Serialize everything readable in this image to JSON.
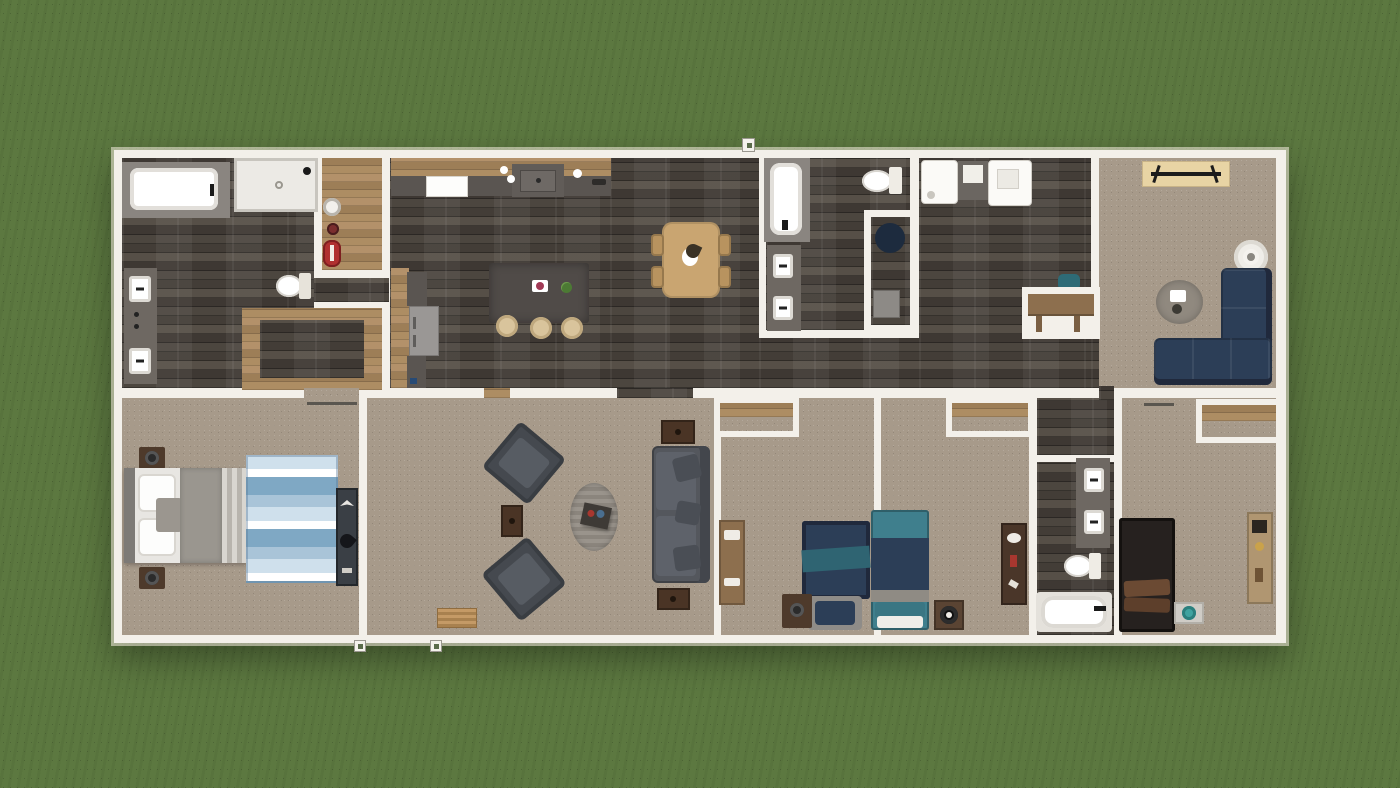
{
  "scene": {
    "type": "3d-floor-plan-top-down-render",
    "environment": "green grass lawn surrounding a single rectangular manufactured home",
    "orientation": "overhead view, no visible text or UI chrome"
  },
  "palette": {
    "grass": "#5c7840",
    "wall": "#f3f0ea",
    "wallEdge": "#cfcabe",
    "woodDark": "#453f3a",
    "woodLight": "#a8895f",
    "carpet": "#a79a8a",
    "counter": "#5a5551",
    "counterDark": "#6e6862",
    "stone": "#504b48",
    "navy": "#2c3e57",
    "navyDark": "#20293c",
    "sofaGray": "#54575d",
    "teal": "#3f7f8d",
    "tealChair": "#2e6b76",
    "dining": "#c9a571",
    "tableBrown": "#4a3425",
    "deskWood": "#8d6f4e",
    "consoleWood": "#e8d4a4",
    "tub": "#ffffff",
    "fixtureGray": "#8a8580",
    "red": "#b03030",
    "rugBlue1": "#cfe0ec",
    "rugBlue2": "#7fa8c4",
    "bedDark": "#26211f"
  },
  "rooms": [
    {
      "name": "Primary bathroom",
      "floor": "dark wood",
      "fixtures": [
        "garden tub",
        "walk-in shower",
        "double vanity",
        "toilet"
      ]
    },
    {
      "name": "Utility hall",
      "floor": "light wood",
      "fixtures": [
        "fire extinguisher",
        "gauge",
        "round fixture"
      ]
    },
    {
      "name": "Walk-in closet",
      "floor": "light wood border with dark inset"
    },
    {
      "name": "Kitchen / dining great room",
      "floor": "dark wood",
      "fixtures": [
        "upper cabinets",
        "range",
        "sink run",
        "refrigerator",
        "island with 3 stools",
        "dining table with 4 chairs"
      ]
    },
    {
      "name": "Hall bathroom",
      "floor": "dark wood",
      "fixtures": [
        "soaking tub",
        "toilet",
        "double vanity",
        "water-closet nook"
      ]
    },
    {
      "name": "Laundry room",
      "floor": "dark wood",
      "fixtures": [
        "washer",
        "cabinet",
        "dryer",
        "built-in desk with teal chair"
      ]
    },
    {
      "name": "Family room",
      "floor": "carpet",
      "fixtures": [
        "media console",
        "ceiling fan",
        "round rug with plant",
        "navy L-sectional"
      ]
    },
    {
      "name": "Primary bedroom",
      "floor": "carpet",
      "fixtures": [
        "king bed",
        "two nightstands with lamps",
        "blue striped rug",
        "dresser"
      ]
    },
    {
      "name": "Living room",
      "floor": "carpet",
      "fixtures": [
        "two angled armchairs",
        "side table",
        "oval rug",
        "coffee table",
        "gray sofa",
        "two end tables",
        "door mat"
      ]
    },
    {
      "name": "Bedroom 3",
      "floor": "carpet",
      "fixtures": [
        "desk",
        "navy bed with teal throw",
        "reading chair",
        "nightstand",
        "closet"
      ]
    },
    {
      "name": "Bedroom 4",
      "floor": "carpet",
      "fixtures": [
        "teal bed",
        "speaker nightstand",
        "dresser",
        "closet"
      ]
    },
    {
      "name": "Guest bathroom",
      "floor": "dark wood",
      "fixtures": [
        "double vanity",
        "toilet",
        "tub"
      ]
    },
    {
      "name": "Bedroom 5",
      "floor": "carpet",
      "fixtures": [
        "dark bed",
        "nightstand with teal lamp",
        "bookshelf",
        "closet"
      ]
    }
  ],
  "exterior_markers": [
    "front-door pin on top wall",
    "two utility pins below living room wall"
  ]
}
